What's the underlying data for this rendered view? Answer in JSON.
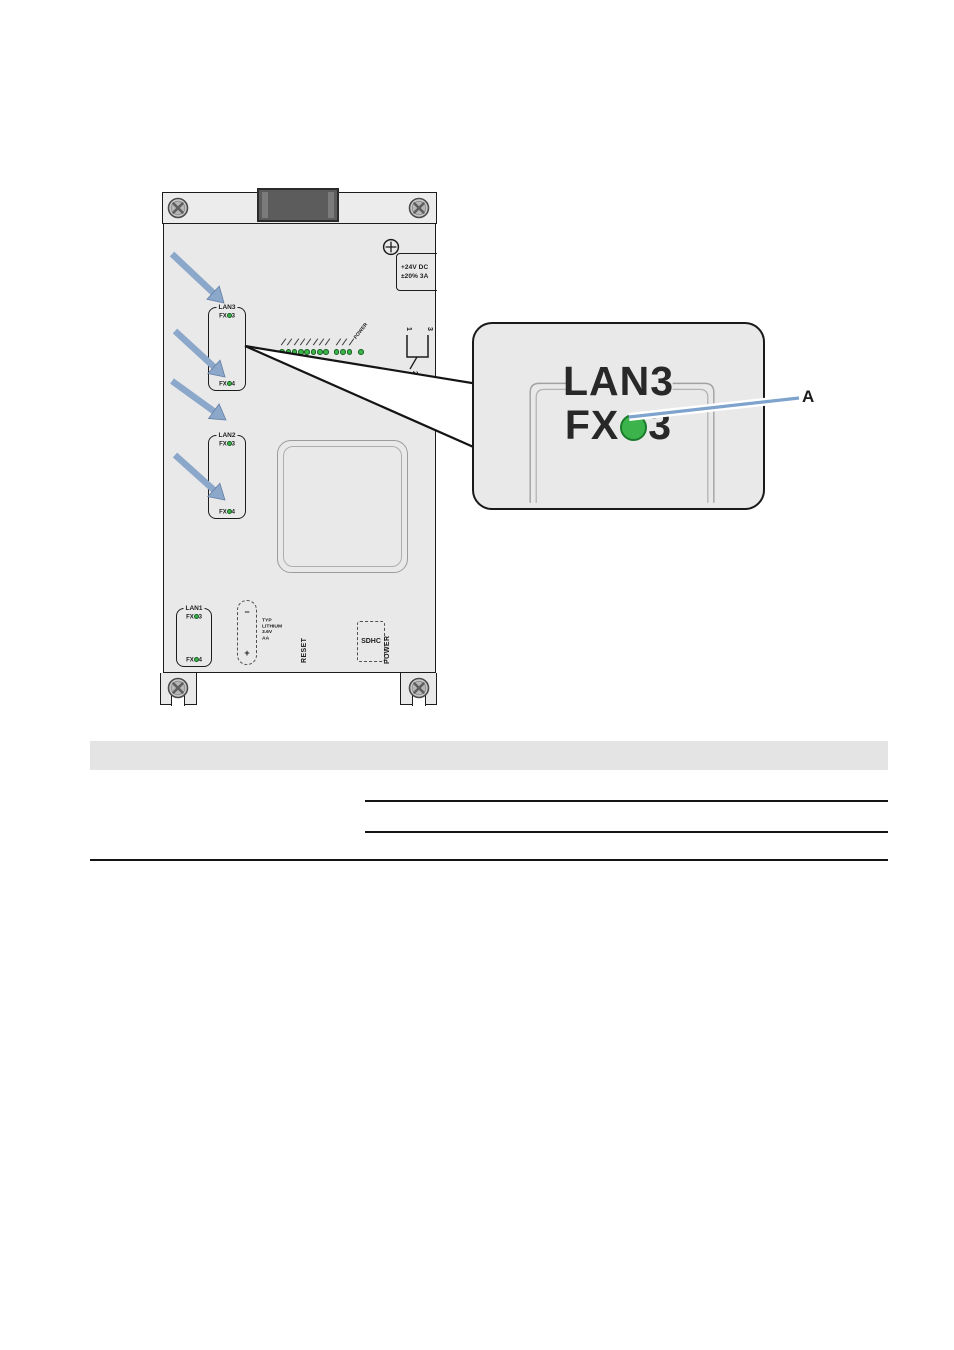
{
  "illustration": {
    "power_rating_line1": "+24V DC",
    "power_rating_line2": "±20% 3A",
    "ports": [
      {
        "name": "LAN3",
        "fx_prefix": "FX",
        "top_num": "3",
        "bottom_num": "4"
      },
      {
        "name": "LAN2",
        "fx_prefix": "FX",
        "top_num": "3",
        "bottom_num": "4"
      },
      {
        "name": "LAN1",
        "fx_prefix": "FX",
        "top_num": "3",
        "bottom_num": "4"
      }
    ],
    "led_panel": {
      "group1_count": 8,
      "group2_count": 3,
      "power_label": "POWER"
    },
    "relay_contact_pins": {
      "top_left": "1",
      "top_right": "3",
      "bottom": "2"
    },
    "battery": {
      "minus_label": "−",
      "plus_label": "+",
      "spec_lines": [
        "TYP",
        "LITHIUM",
        "3.6V",
        "AA"
      ]
    },
    "reset_label": "RESET",
    "sdhc_label": "SDHC",
    "power_label": "POWER"
  },
  "callout": {
    "port_name": "LAN3",
    "fx_prefix": "FX",
    "fx_number": "3",
    "marker_label": "A"
  },
  "colors": {
    "panel": "#e9e9e9",
    "outline": "#1c1c1c",
    "led_green": "#3cb34b",
    "arrow_blue": "#8ba7ca",
    "leader_blue": "#7ea3cc",
    "table_band": "#e4e4e4"
  }
}
